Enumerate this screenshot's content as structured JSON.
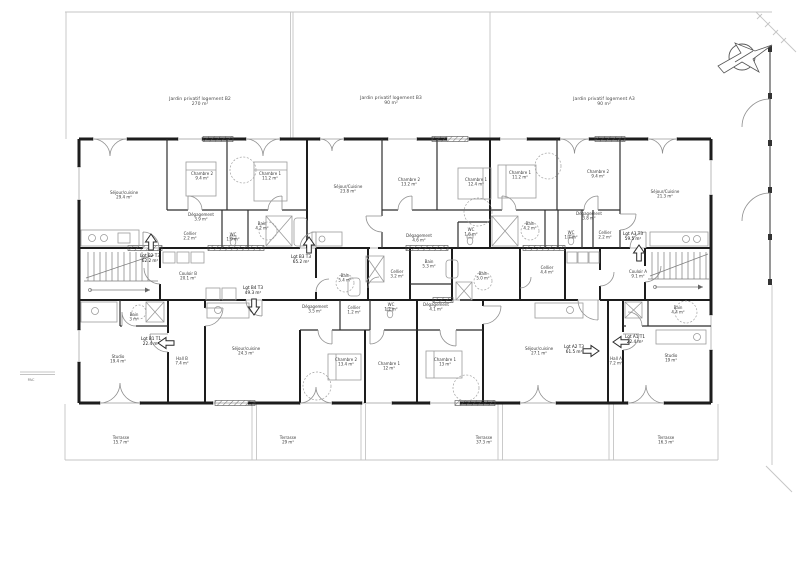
{
  "drawing": {
    "type": "floor-plan",
    "orientation": "north-arrow"
  },
  "gardens": [
    {
      "name": "Jardin privatif logement B2",
      "area": "270 m²"
    },
    {
      "name": "Jardin privatif logement B3",
      "area": "90 m²"
    },
    {
      "name": "Jardin privatif logement A3",
      "area": "90 m²"
    }
  ],
  "terraces": [
    {
      "name": "Terrasse",
      "area": "15.7 m²"
    },
    {
      "name": "Terrasse",
      "area": "29 m²"
    },
    {
      "name": "Terrasse",
      "area": "37.3 m²"
    },
    {
      "name": "Terrasse",
      "area": "16.3 m²"
    }
  ],
  "units": [
    {
      "id": "Lgt B2 T3",
      "area": "62.2 m²"
    },
    {
      "id": "Lgt B3 T3",
      "area": "65.2 m²"
    },
    {
      "id": "Lgt A3 T3",
      "area": "59.5 m²"
    },
    {
      "id": "Lgt B4 T3",
      "area": "49.3 m²"
    },
    {
      "id": "Lgt B1 T1",
      "area": "22.4 m²"
    },
    {
      "id": "Lgt A2 T3",
      "area": "61.5 m²"
    },
    {
      "id": "Lgt A1 T1",
      "area": "22.4 m²"
    }
  ],
  "rooms": [
    {
      "name": "Séjour/cuisine",
      "area": "29.4 m²"
    },
    {
      "name": "Chambre 2",
      "area": "9.4 m²"
    },
    {
      "name": "Chambre 1",
      "area": "11.2 m²"
    },
    {
      "name": "Dégagement",
      "area": "3.9 m²"
    },
    {
      "name": "Cellier",
      "area": "2.2 m²"
    },
    {
      "name": "WC",
      "area": "1.9 m²"
    },
    {
      "name": "Bain",
      "area": "4.2 m²"
    },
    {
      "name": "Séjour/Cuisine",
      "area": "23.8 m²"
    },
    {
      "name": "Chambre 2",
      "area": "13.2 m²"
    },
    {
      "name": "Chambre 1",
      "area": "12.4 m²"
    },
    {
      "name": "Dégagement",
      "area": "4.6 m²"
    },
    {
      "name": "WC",
      "area": "1.6 m²"
    },
    {
      "name": "Chambre 1",
      "area": "11.2 m²"
    },
    {
      "name": "Chambre 2",
      "area": "9.4 m²"
    },
    {
      "name": "Séjour/Cuisine",
      "area": "21.3 m²"
    },
    {
      "name": "Dégagement",
      "area": "3.8 m²"
    },
    {
      "name": "Bain",
      "area": "4.2 m²"
    },
    {
      "name": "WC",
      "area": "1.7 m²"
    },
    {
      "name": "Cellier",
      "area": "2.2 m²"
    },
    {
      "name": "Couloir B",
      "area": "20.1 m²"
    },
    {
      "name": "Bain",
      "area": "5.4 m²"
    },
    {
      "name": "Cellier",
      "area": "3.2 m²"
    },
    {
      "name": "Bain",
      "area": "5.3 m²"
    },
    {
      "name": "Bain",
      "area": "5.0 m²"
    },
    {
      "name": "Cellier",
      "area": "4.4 m²"
    },
    {
      "name": "Couloir A",
      "area": "9.1 m²"
    },
    {
      "name": "WC",
      "area": "1.2 m²"
    },
    {
      "name": "Dégagement",
      "area": "4.1 m²"
    },
    {
      "name": "Bain",
      "area": "3 m²"
    },
    {
      "name": "Studio",
      "area": "19.4 m²"
    },
    {
      "name": "Hall B",
      "area": "7.4 m²"
    },
    {
      "name": "Séjour/cuisine",
      "area": "24.3 m²"
    },
    {
      "name": "Dégagement",
      "area": "3.5 m²"
    },
    {
      "name": "Cellier",
      "area": "1.2 m²"
    },
    {
      "name": "Chambre 2",
      "area": "13.4 m²"
    },
    {
      "name": "Chambre 1",
      "area": "12 m²"
    },
    {
      "name": "Chambre 1",
      "area": "13 m²"
    },
    {
      "name": "Séjour/cuisine",
      "area": "27.1 m²"
    },
    {
      "name": "Hall A",
      "area": "7.2 m²"
    },
    {
      "name": "Bain",
      "area": "4.4 m²"
    },
    {
      "name": "Studio",
      "area": "19 m²"
    }
  ],
  "annotations": {
    "pac": "PAC"
  }
}
